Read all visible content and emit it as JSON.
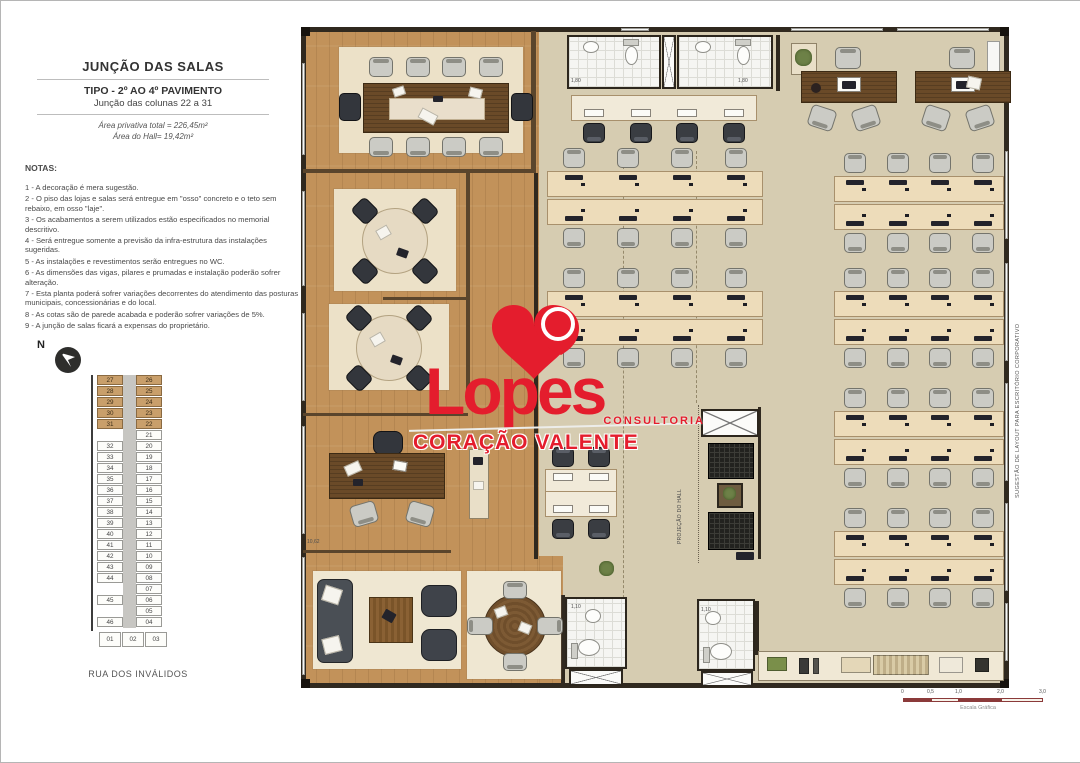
{
  "title_block": {
    "title": "JUNÇÃO DAS SALAS",
    "subtitle": "TIPO - 2º AO 4º PAVIMENTO",
    "subtitle2": "Junção das colunas 22 a 31",
    "area_line1": "Área privativa total = 226,45m²",
    "area_line2": "Área do Hall= 19,42m²"
  },
  "notes": {
    "heading": "NOTAS:",
    "items": [
      "1 - A decoração é mera sugestão.",
      "2 - O piso das lojas e salas será entregue em \"osso\" concreto e o teto sem rebaixo, em osso \"laje\".",
      "3 - Os acabamentos a serem utilizados estão especificados no memorial descritivo.",
      "4 - Será entregue somente a previsão da infra-estrutura das instalações sugeridas.",
      "5 - As instalações e revestimentos serão entregues no WC.",
      "6 - As dimensões das vigas, pilares e prumadas e instalação poderão sofrer alteração.",
      "7 - Esta planta poderá sofrer variações decorrentes do atendimento das posturas municipais, concessionárias e do local.",
      "8 - As cotas são de parede acabada e poderão sofrer variações de 5%.",
      "9 - A junção de salas ficará a expensas do proprietário."
    ]
  },
  "north_label": "N",
  "key_plan": {
    "rows": [
      {
        "l": "27",
        "r": "26",
        "hl": true
      },
      {
        "l": "28",
        "r": "25",
        "hl": true
      },
      {
        "l": "29",
        "r": "24",
        "hl": true
      },
      {
        "l": "30",
        "r": "23",
        "hl": true
      },
      {
        "l": "31",
        "r": "22",
        "hl": true
      },
      {
        "l": "",
        "r": "21",
        "hl": false
      },
      {
        "l": "32",
        "r": "20",
        "hl": false
      },
      {
        "l": "33",
        "r": "19",
        "hl": false
      },
      {
        "l": "34",
        "r": "18",
        "hl": false
      },
      {
        "l": "35",
        "r": "17",
        "hl": false
      },
      {
        "l": "36",
        "r": "16",
        "hl": false
      },
      {
        "l": "37",
        "r": "15",
        "hl": false
      },
      {
        "l": "38",
        "r": "14",
        "hl": false
      },
      {
        "l": "39",
        "r": "13",
        "hl": false
      },
      {
        "l": "40",
        "r": "12",
        "hl": false
      },
      {
        "l": "41",
        "r": "11",
        "hl": false
      },
      {
        "l": "42",
        "r": "10",
        "hl": false
      },
      {
        "l": "43",
        "r": "09",
        "hl": false
      },
      {
        "l": "44",
        "r": "08",
        "hl": false
      },
      {
        "l": "",
        "r": "07",
        "hl": false
      },
      {
        "l": "45",
        "r": "06",
        "hl": false
      },
      {
        "l": "",
        "r": "05",
        "hl": false
      },
      {
        "l": "46",
        "r": "04",
        "hl": false
      }
    ],
    "bottom": [
      "01",
      "02",
      "03"
    ]
  },
  "street_label": "RUA DOS INVÁLIDOS",
  "logo": {
    "brand": "Lopes",
    "tagline_small": "CONSULTORIA",
    "tagline": "CORAÇÃO VALENTE",
    "red": "#e41d2d"
  },
  "side_label": "SUGESTÃO DE LAYOUT PARA ESCRITÓRIO CORPORATIVO",
  "plan": {
    "hall_label": "PROJEÇÃO DO HALL",
    "dim_labels": [
      {
        "text": "1,80",
        "x": 570,
        "y": 77
      },
      {
        "text": "1,80",
        "x": 737,
        "y": 77
      },
      {
        "text": "1,10",
        "x": 570,
        "y": 603
      },
      {
        "text": "1,10",
        "x": 700,
        "y": 606
      },
      {
        "text": "10,62",
        "x": 306,
        "y": 538
      }
    ],
    "benches": [
      {
        "x": 570,
        "y": 94,
        "w": 186,
        "stations": 4,
        "facing": "down",
        "style": "dark"
      },
      {
        "x": 544,
        "y": 468,
        "w": 72,
        "stations": 2,
        "facing": "up",
        "style": "dark"
      },
      {
        "x": 544,
        "y": 490,
        "w": 72,
        "stations": 2,
        "facing": "down",
        "style": "dark"
      },
      {
        "x": 546,
        "y": 170,
        "w": 216,
        "stations": 4,
        "facing": "up",
        "style": "light"
      },
      {
        "x": 546,
        "y": 198,
        "w": 216,
        "stations": 4,
        "facing": "down",
        "style": "light"
      },
      {
        "x": 546,
        "y": 290,
        "w": 216,
        "stations": 4,
        "facing": "up",
        "style": "light"
      },
      {
        "x": 546,
        "y": 318,
        "w": 216,
        "stations": 4,
        "facing": "down",
        "style": "light"
      },
      {
        "x": 833,
        "y": 175,
        "w": 170,
        "stations": 4,
        "facing": "up",
        "style": "light"
      },
      {
        "x": 833,
        "y": 203,
        "w": 170,
        "stations": 4,
        "facing": "down",
        "style": "light"
      },
      {
        "x": 833,
        "y": 290,
        "w": 170,
        "stations": 4,
        "facing": "up",
        "style": "light"
      },
      {
        "x": 833,
        "y": 318,
        "w": 170,
        "stations": 4,
        "facing": "down",
        "style": "light"
      },
      {
        "x": 833,
        "y": 410,
        "w": 170,
        "stations": 4,
        "facing": "up",
        "style": "light"
      },
      {
        "x": 833,
        "y": 438,
        "w": 170,
        "stations": 4,
        "facing": "down",
        "style": "light"
      },
      {
        "x": 833,
        "y": 530,
        "w": 170,
        "stations": 4,
        "facing": "up",
        "style": "light"
      },
      {
        "x": 833,
        "y": 558,
        "w": 170,
        "stations": 4,
        "facing": "down",
        "style": "light"
      }
    ],
    "colors": {
      "wood": "#c2925a",
      "floor": "#d6ccb1",
      "wall": "#30291f",
      "desk": "#eddcba",
      "rug": "#ece1c8",
      "dark_wood": "#6a4a28",
      "logo_red": "#e41d2d"
    }
  },
  "scale_bar": {
    "ticks": [
      "0",
      "0,5",
      "1,0",
      "2,0",
      "3,0"
    ],
    "caption": "Escala Gráfica"
  }
}
